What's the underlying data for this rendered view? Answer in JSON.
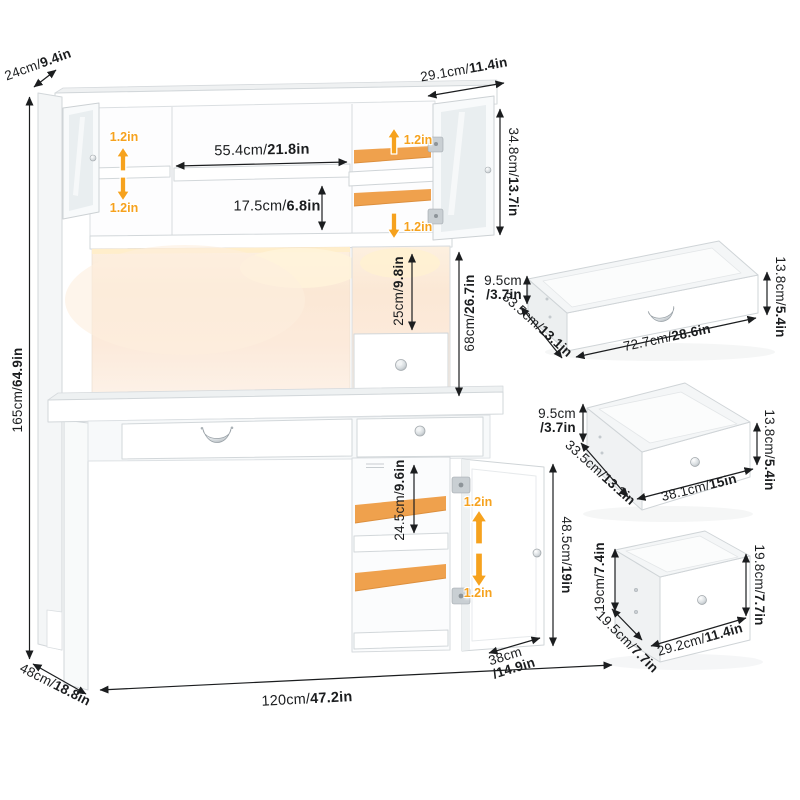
{
  "colors": {
    "accent_orange": "#f6a21e",
    "shelf_orange": "#efa14d",
    "led_glow": "#fbe9d7",
    "dimension_text": "#1b1d1f",
    "furniture_line": "#d2d7da"
  },
  "unit": {
    "top_depth": {
      "cm": "24cm/",
      "in": "9.4in"
    },
    "total_height": {
      "cm": "165cm/",
      "in": "64.9in"
    },
    "hutch_depth": {
      "cm": "29.1cm/",
      "in": "11.4in"
    },
    "upper_cabinet_height": {
      "cm": "34.8cm/",
      "in": "13.7in"
    },
    "shelf_width": {
      "cm": "55.4cm/",
      "in": "21.8in"
    },
    "shelf_spacing": {
      "cm": "17.5cm/",
      "in": "6.8in"
    },
    "cubby_height": {
      "cm": "25cm/",
      "in": "9.8in"
    },
    "hutch_height": {
      "cm": "68cm/",
      "in": "26.7in"
    },
    "cabinet_shelf_height": {
      "cm": "24.5cm/",
      "in": "9.6in"
    },
    "cabinet_height": {
      "cm": "48.5cm/",
      "in": "19in"
    },
    "cabinet_depth": {
      "cm": "38cm",
      "in": "/14.9in"
    },
    "total_width": {
      "cm": "120cm/",
      "in": "47.2in"
    },
    "desk_depth": {
      "cm": "48cm/",
      "in": "18.8in"
    },
    "shelf_adjust": "1.2in"
  },
  "drawers": {
    "large": {
      "front_height": {
        "cm": "9.5cm",
        "in": "/3.7in"
      },
      "depth": {
        "cm": "33.5cm/",
        "in": "13.1in"
      },
      "width": {
        "cm": "72.7cm/",
        "in": "28.6in"
      },
      "side_height": {
        "cm": "13.8cm/",
        "in": "5.4in"
      }
    },
    "medium": {
      "front_height": {
        "cm": "9.5cm",
        "in": "/3.7in"
      },
      "depth": {
        "cm": "33.5cm/",
        "in": "13.1in"
      },
      "width": {
        "cm": "38.1cm/",
        "in": "15in"
      },
      "side_height": {
        "cm": "13.8cm/",
        "in": "5.4in"
      }
    },
    "small": {
      "front_height": {
        "cm": "19cm/",
        "in": "7.4in"
      },
      "depth": {
        "cm": "19.5cm/",
        "in": "7.7in"
      },
      "width": {
        "cm": "29.2cm/",
        "in": "11.4in"
      },
      "side_height": {
        "cm": "19.8cm/",
        "in": "7.7in"
      }
    }
  }
}
